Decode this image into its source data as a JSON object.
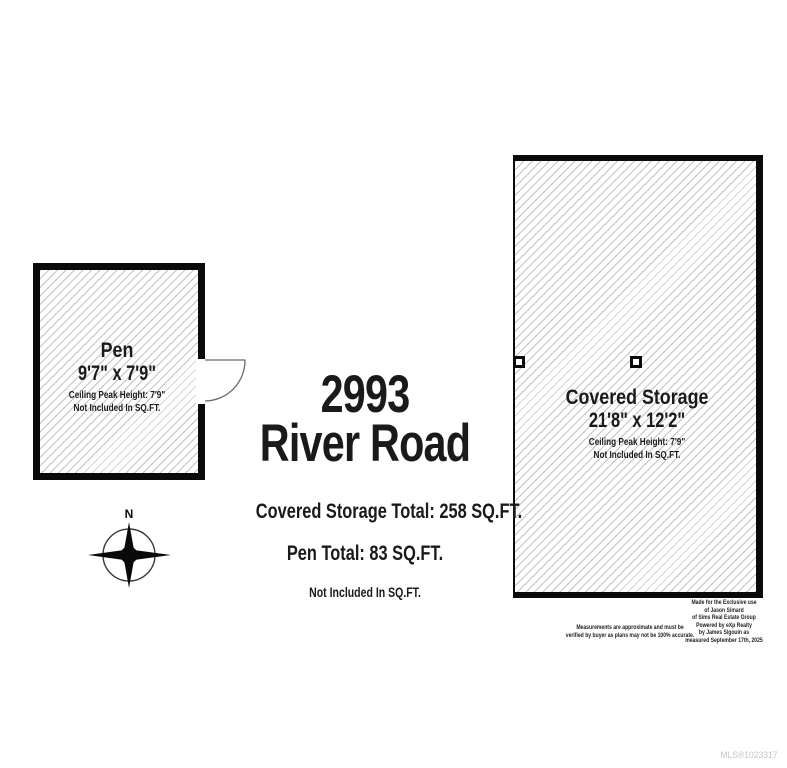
{
  "title": {
    "line1": "2993",
    "line2": "River Road"
  },
  "summary": {
    "covered_storage_total": "Covered Storage Total: 258 SQ.FT.",
    "pen_total": "Pen Total: 83 SQ.FT.",
    "note": "Not Included In SQ.FT."
  },
  "rooms": {
    "pen": {
      "name": "Pen",
      "dimensions": "9'7\" x 7'9\"",
      "ceiling": "Ceiling Peak Height: 7'9\"",
      "note": "Not Included In SQ.FT."
    },
    "covered_storage": {
      "name": "Covered Storage",
      "dimensions": "21'8\" x 12'2\"",
      "ceiling": "Ceiling Peak Height: 7'9\"",
      "note": "Not Included In SQ.FT."
    }
  },
  "compass": {
    "label": "N"
  },
  "disclaimer": {
    "line1": "Measurements are approximate and must be",
    "line2": "verified by buyer as plans may not be 100% accurate."
  },
  "credits": {
    "lines": [
      "Made for the Exclusive use",
      "of Jason Simard",
      "of Sims Real Estate Group",
      "Powered by eXp Realty",
      "by James Sigouin as",
      "measured September 17th, 2025"
    ]
  },
  "mls": {
    "label": "MLS®1023317"
  },
  "colors": {
    "wall": "#0a0a0a",
    "hatch_line": "#c2c2c2",
    "mls_text": "#c5c5c5"
  }
}
